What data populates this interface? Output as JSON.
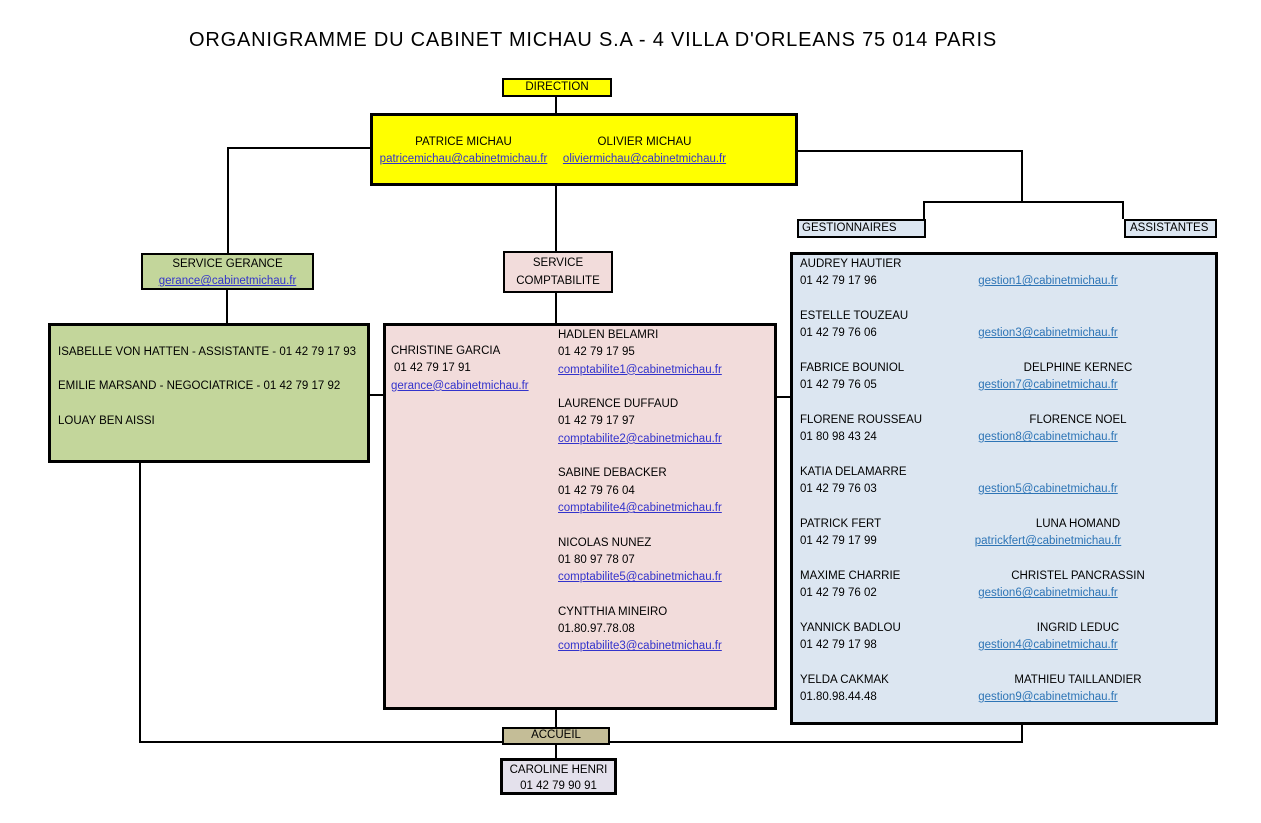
{
  "title": "ORGANIGRAMME DU CABINET MICHAU S.A - 4 VILLA D'ORLEANS 75 014 PARIS",
  "colors": {
    "direction_fill": "#ffff00",
    "gerance_fill": "#c3d69b",
    "comptabilite_fill": "#f2dcdb",
    "gestion_fill": "#dce6f1",
    "accueil_fill": "#c4bd97",
    "caroline_fill": "#e4e1ec",
    "link_dark": "#3333cc",
    "link_light": "#2e75b6",
    "line": "#000000"
  },
  "direction": {
    "label": "DIRECTION",
    "members": [
      {
        "name": "PATRICE MICHAU",
        "email": "patricemichau@cabinetmichau.fr"
      },
      {
        "name": "OLIVIER MICHAU",
        "email": "oliviermichau@cabinetmichau.fr"
      }
    ]
  },
  "gerance": {
    "header": "SERVICE GERANCE",
    "header_email": "gerance@cabinetmichau.fr",
    "staff": [
      "ISABELLE VON HATTEN - ASSISTANTE  - 01 42 79 17 93",
      "EMILIE MARSAND - NEGOCIATRICE - 01 42 79 17 92",
      "LOUAY BEN AISSI"
    ]
  },
  "comptabilite": {
    "header_line1": "SERVICE",
    "header_line2": "COMPTABILITE",
    "manager": {
      "name": "CHRISTINE GARCIA",
      "phone": "01 42 79 17 91",
      "email": "gerance@cabinetmichau.fr"
    },
    "staff": [
      {
        "name": "HADLEN BELAMRI",
        "phone": "01 42 79 17 95",
        "email": "comptabilite1@cabinetmichau.fr"
      },
      {
        "name": "LAURENCE DUFFAUD",
        "phone": "01 42 79 17 97",
        "email": "comptabilite2@cabinetmichau.fr"
      },
      {
        "name": "SABINE DEBACKER",
        "phone": "01 42 79 76 04",
        "email": "comptabilite4@cabinetmichau.fr"
      },
      {
        "name": "NICOLAS NUNEZ",
        "phone": "01 80 97 78 07",
        "email": "comptabilite5@cabinetmichau.fr"
      },
      {
        "name": "CYNTTHIA MINEIRO",
        "phone": "01.80.97.78.08",
        "email": "comptabilite3@cabinetmichau.fr"
      }
    ]
  },
  "gestion": {
    "header_gestionnaires": "GESTIONNAIRES",
    "header_assistantes": "ASSISTANTES",
    "rows": [
      {
        "gestionnaire": "AUDREY HAUTIER",
        "phone": "01 42 79 17 96",
        "assistante": "",
        "email": "gestion1@cabinetmichau.fr"
      },
      {
        "gestionnaire": "ESTELLE TOUZEAU",
        "phone": "01 42 79 76 06",
        "assistante": "",
        "email": "gestion3@cabinetmichau.fr"
      },
      {
        "gestionnaire": "FABRICE BOUNIOL",
        "phone": "01 42 79 76 05",
        "assistante": "DELPHINE KERNEC",
        "email": "gestion7@cabinetmichau.fr"
      },
      {
        "gestionnaire": "FLORENE ROUSSEAU",
        "phone": "01 80 98 43 24",
        "assistante": "FLORENCE NOEL",
        "email": "gestion8@cabinetmichau.fr"
      },
      {
        "gestionnaire": "KATIA DELAMARRE",
        "phone": "01 42 79 76 03",
        "assistante": "",
        "email": "gestion5@cabinetmichau.fr"
      },
      {
        "gestionnaire": "PATRICK FERT",
        "phone": "01 42 79 17 99",
        "assistante": "LUNA HOMAND",
        "email": "patrickfert@cabinetmichau.fr"
      },
      {
        "gestionnaire": "MAXIME CHARRIE",
        "phone": "01 42 79 76 02",
        "assistante": "CHRISTEL PANCRASSIN",
        "email": "gestion6@cabinetmichau.fr"
      },
      {
        "gestionnaire": "YANNICK BADLOU",
        "phone": "01 42 79 17 98",
        "assistante": "INGRID LEDUC",
        "email": "gestion4@cabinetmichau.fr"
      },
      {
        "gestionnaire": "YELDA CAKMAK",
        "phone": "01.80.98.44.48",
        "assistante": "MATHIEU TAILLANDIER",
        "email": "gestion9@cabinetmichau.fr"
      }
    ]
  },
  "accueil": {
    "label": "ACCUEIL",
    "name": "CAROLINE HENRI",
    "phone": "01 42 79 90 91"
  }
}
